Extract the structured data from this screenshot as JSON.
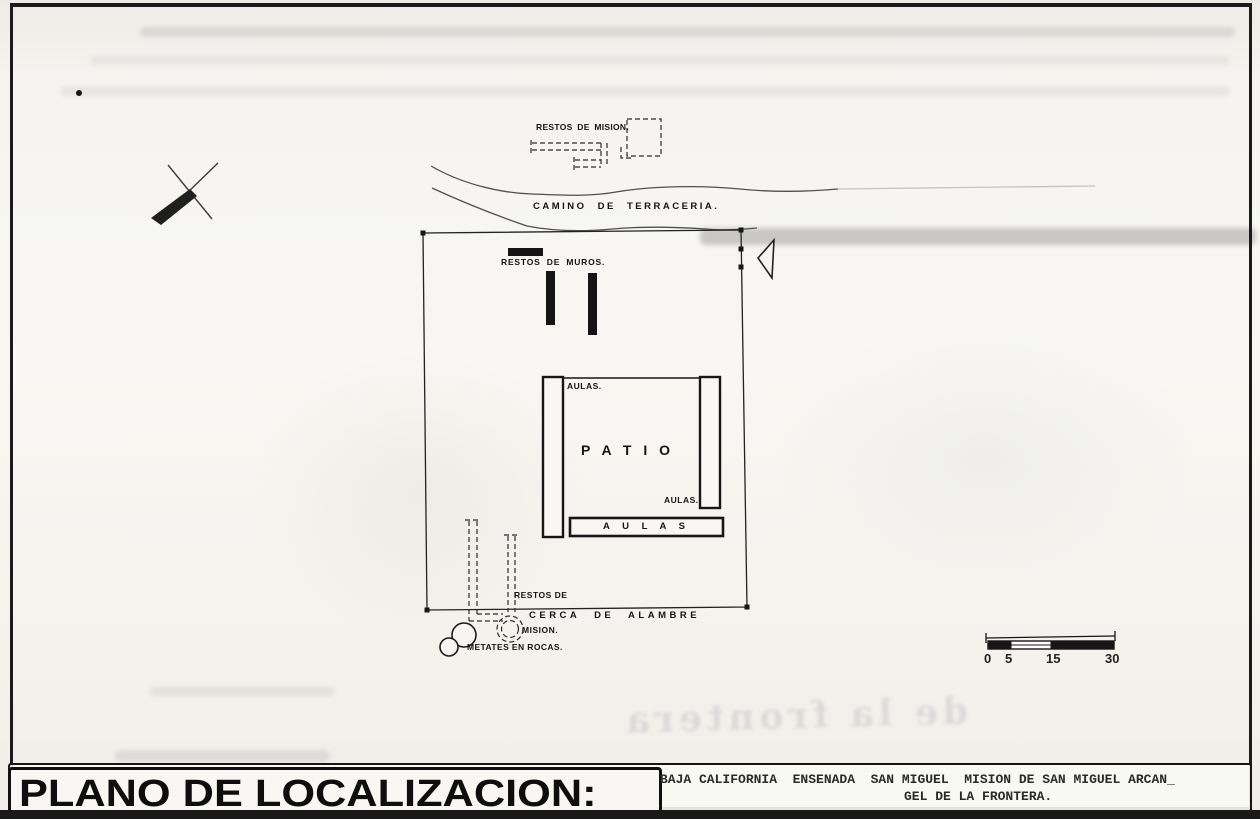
{
  "scan": {
    "title": "PLANO DE LOCALIZACION:",
    "location": {
      "line1": "BAJA CALIFORNIA  ENSENADA  SAN MIGUEL  MISION DE SAN MIGUEL ARCAN_",
      "line2": "GEL DE LA FRONTERA."
    }
  },
  "plan": {
    "labels": {
      "mission_ruins_top": "RESTOS DE MISION.",
      "dirt_road": "CAMINO DE TERRACERIA.",
      "wall_remains": "RESTOS DE MUROS.",
      "classrooms_top": "AULAS.",
      "patio": "P A T I O",
      "classrooms_right": "AULAS.",
      "classrooms_block": "A U L A S",
      "mission_ruins_south_line1": "RESTOS DE",
      "mission_ruins_south_line2": "MISION.",
      "wire_fence": "CERCA DE ALAMBRE",
      "metates": "METATES EN ROCAS."
    },
    "scale_bar": {
      "ticks": [
        "0",
        "5",
        "15",
        "30"
      ]
    },
    "bleedthrough_text": "de la frontera"
  },
  "colors": {
    "ink": "#1c1c1c",
    "paper": "#f4f2ee"
  }
}
